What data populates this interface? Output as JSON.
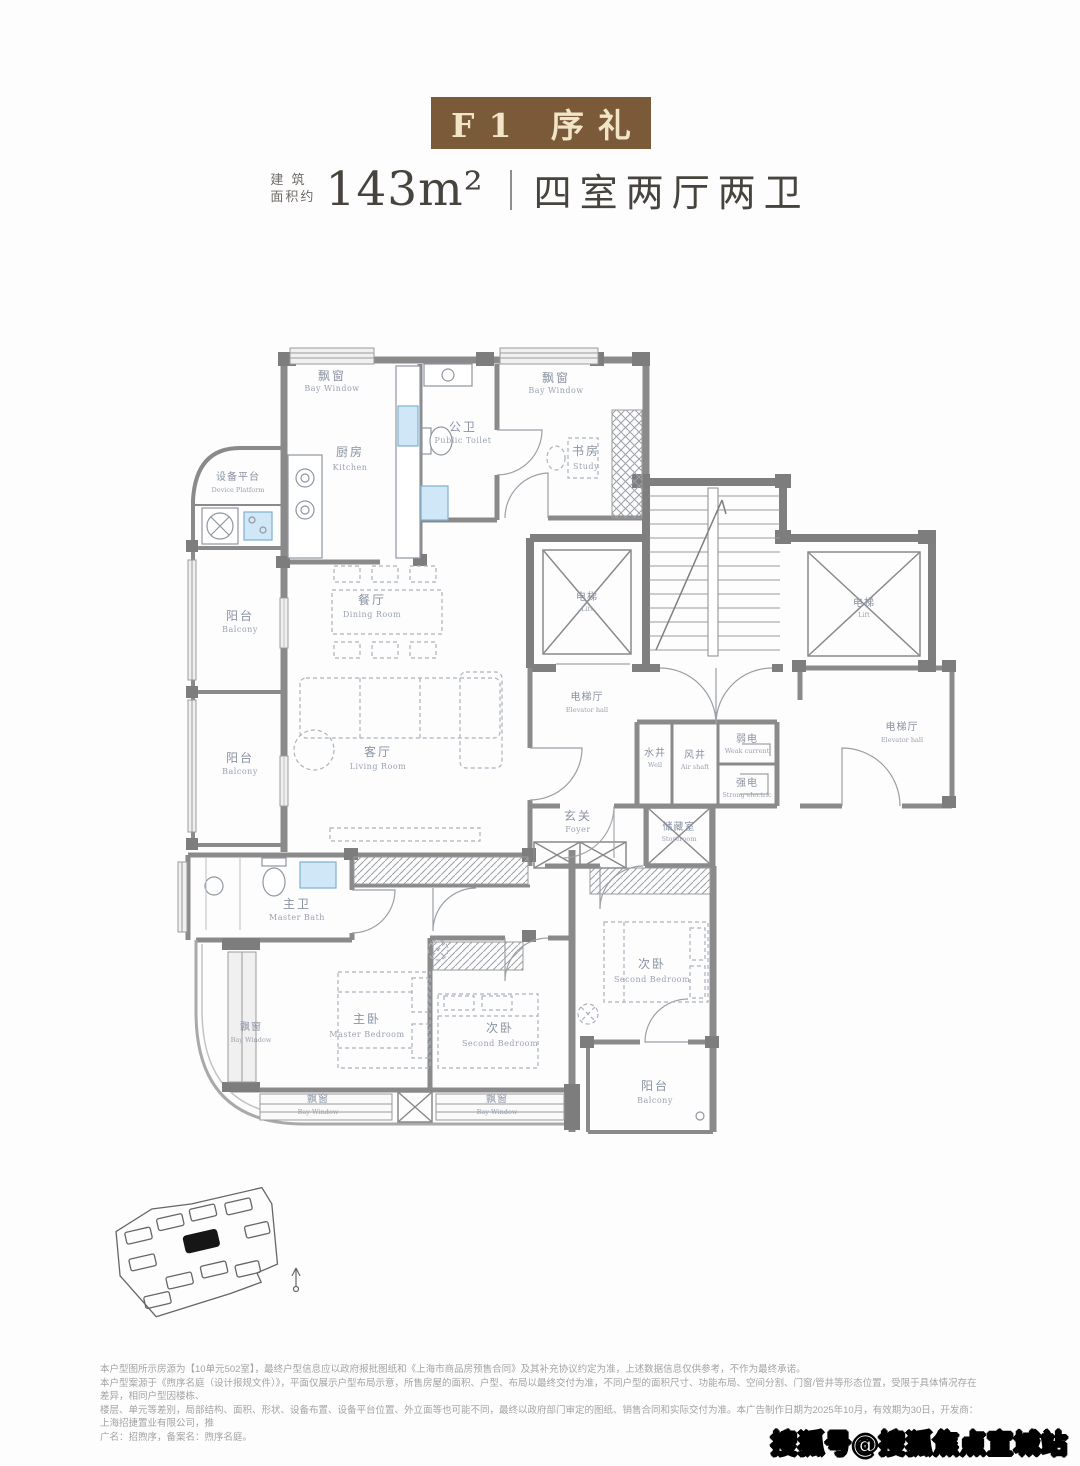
{
  "header": {
    "plan_tag": "F1 序礼",
    "area_label_line1": "建 筑",
    "area_label_line2": "面积约",
    "area_value": "143m²",
    "layout_text": "四室两厅两卫"
  },
  "floorplan": {
    "rooms": {
      "bay_window": {
        "cn": "飘窗",
        "en": "Bay Window"
      },
      "kitchen": {
        "cn": "厨房",
        "en": "Kitchen"
      },
      "device_platform": {
        "cn": "设备平台",
        "en": "Device Platform"
      },
      "public_toilet": {
        "cn": "公卫",
        "en": "Public Toilet"
      },
      "study": {
        "cn": "书房",
        "en": "Study"
      },
      "dining_room": {
        "cn": "餐厅",
        "en": "Dining Room"
      },
      "living_room": {
        "cn": "客厅",
        "en": "Living Room"
      },
      "balcony": {
        "cn": "阳台",
        "en": "Balcony"
      },
      "lift": {
        "cn": "电梯",
        "en": "Lift"
      },
      "elevator_hall": {
        "cn": "电梯厅",
        "en": "Elevator hall"
      },
      "well": {
        "cn": "水井",
        "en": "Well"
      },
      "air_shaft": {
        "cn": "风井",
        "en": "Air shaft"
      },
      "weak_current": {
        "cn": "弱电",
        "en": "Weak current"
      },
      "strong_current": {
        "cn": "强电",
        "en": "Strong electric"
      },
      "foyer": {
        "cn": "玄关",
        "en": "Foyer"
      },
      "storeroom": {
        "cn": "储藏室",
        "en": "Storeroom"
      },
      "master_bath": {
        "cn": "主卫",
        "en": "Master Bath"
      },
      "master_bedroom": {
        "cn": "主卧",
        "en": "Master Bedroom"
      },
      "second_bedroom": {
        "cn": "次卧",
        "en": "Second Bedroom"
      }
    }
  },
  "disclaimer": {
    "line1": "本户型图所示房源为【10单元502室】，最终户型信息应以政府报批图纸和《上海市商品房预售合同》及其补充协议约定为准，上述数据信息仅供参考，不作为最终承诺。",
    "line2": "本户型案源于《煦序名庭（设计报规文件）》，平面仅展示户型布局示意，所售房屋的面积、户型、布局以最终交付为准，不同户型的面积尺寸、功能布局、空间分割、门窗/管井等形态位置，受限于具体情况存在差异，相同户型因楼栋、",
    "line3": "楼层、单元等差别，局部结构、面积、形状、设备布置、设备平台位置、外立面等也可能不同，最终以政府部门审定的图纸、销售合同和实际交付为准。本广告制作日期为2025年10月，有效期为30日，开发商：上海招捷置业有限公司，推",
    "line4": "广名：招煦序，备案名：煦序名庭。"
  },
  "watermark": "搜狐号@搜狐焦点宣城站",
  "colors": {
    "title_box": "#7a5a39",
    "title_text": "#f2e4c6",
    "heading_text": "#47443e",
    "room_label": "#8a93a3",
    "wall": "#8a8a8a",
    "fixture_blue": "#cfe7f6"
  }
}
